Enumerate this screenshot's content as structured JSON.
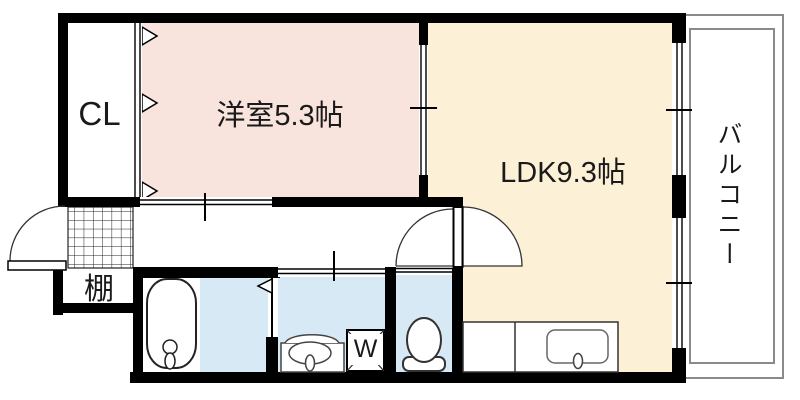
{
  "rooms": {
    "closet": {
      "label": "CL"
    },
    "western_room": {
      "label": "洋室5.3帖"
    },
    "ldk": {
      "label": "LDK9.3帖"
    },
    "balcony": {
      "label": "バルコニー"
    },
    "shelf": {
      "label": "棚"
    }
  },
  "fixtures": {
    "washing_machine_label": "W"
  },
  "colors": {
    "wall": "#000000",
    "western_room": "#f8e4dd",
    "ldk": "#fcf0d6",
    "wet_area": "#d6e9f5",
    "balcony_line": "#8a8a8a",
    "fixture_stroke": "#333333"
  },
  "icons": {
    "bathtub": "bathtub-icon",
    "toilet": "toilet-icon",
    "washbasin": "washbasin-icon",
    "kitchen_sink": "kitchen-sink-icon",
    "washing_machine": "washing-machine-icon",
    "entrance_door": "door-swing-icon",
    "room_door": "door-swing-icon",
    "folding_door": "folding-door-chevron-icon",
    "sliding_door": "sliding-door-icon",
    "entrance_mat": "entrance-grid-icon"
  }
}
